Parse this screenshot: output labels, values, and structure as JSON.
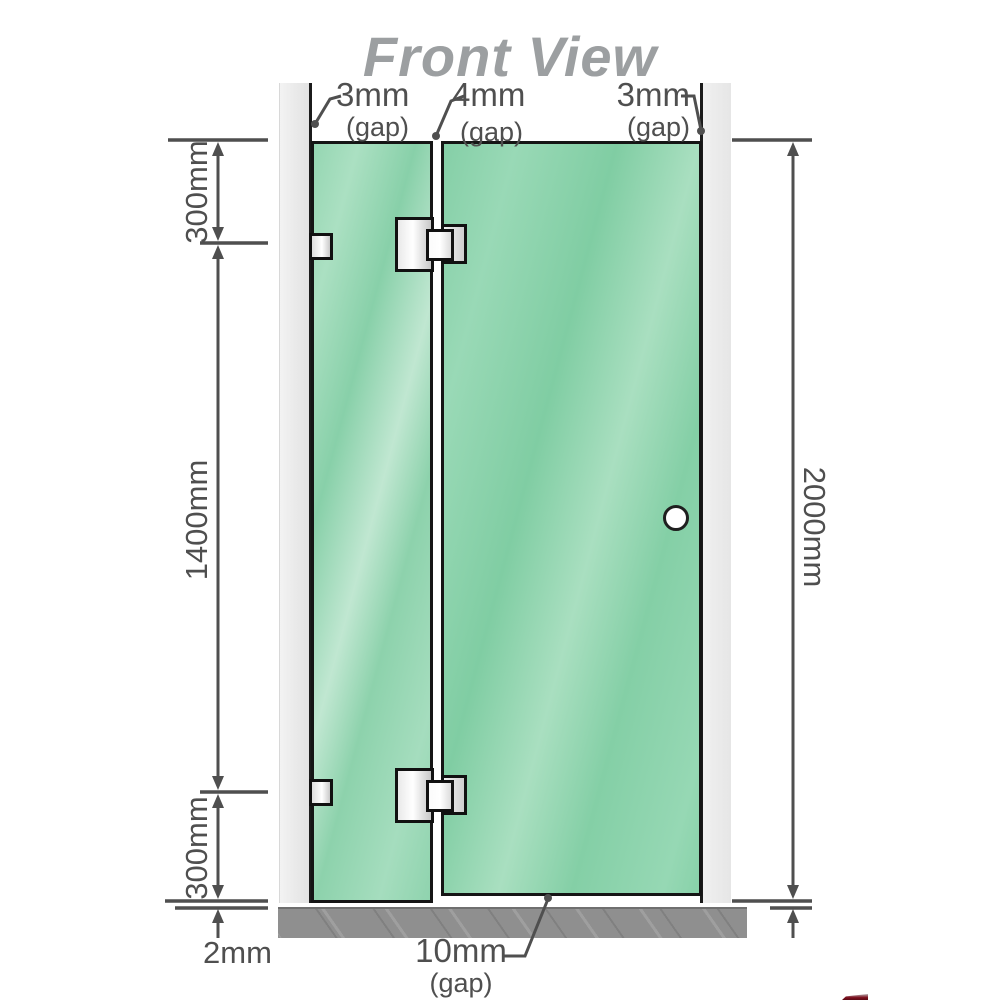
{
  "title": "Front View",
  "dimensions": {
    "left_top": "300mm",
    "left_middle": "1400mm",
    "left_bottom": "300mm",
    "right": "2000mm",
    "bottom_left": "2mm"
  },
  "gaps": {
    "top_left": {
      "value": "3mm",
      "label": "(gap)"
    },
    "top_middle": {
      "value": "4mm",
      "label": "(gap)"
    },
    "top_right": {
      "value": "3mm",
      "label": "(gap)"
    },
    "bottom": {
      "value": "10mm",
      "label": "(gap)"
    }
  },
  "colors": {
    "glass_green": "#85cfa7",
    "glass_highlight": "#c0e7d1",
    "wall_gray": "#e8e8e8",
    "floor_gray": "#8f8f8f",
    "line_gray": "#4f4f4f",
    "title_gray": "#9c9fa1",
    "hardware_metal": "#e9e9e9",
    "corner_red": "#7c0d1c"
  }
}
